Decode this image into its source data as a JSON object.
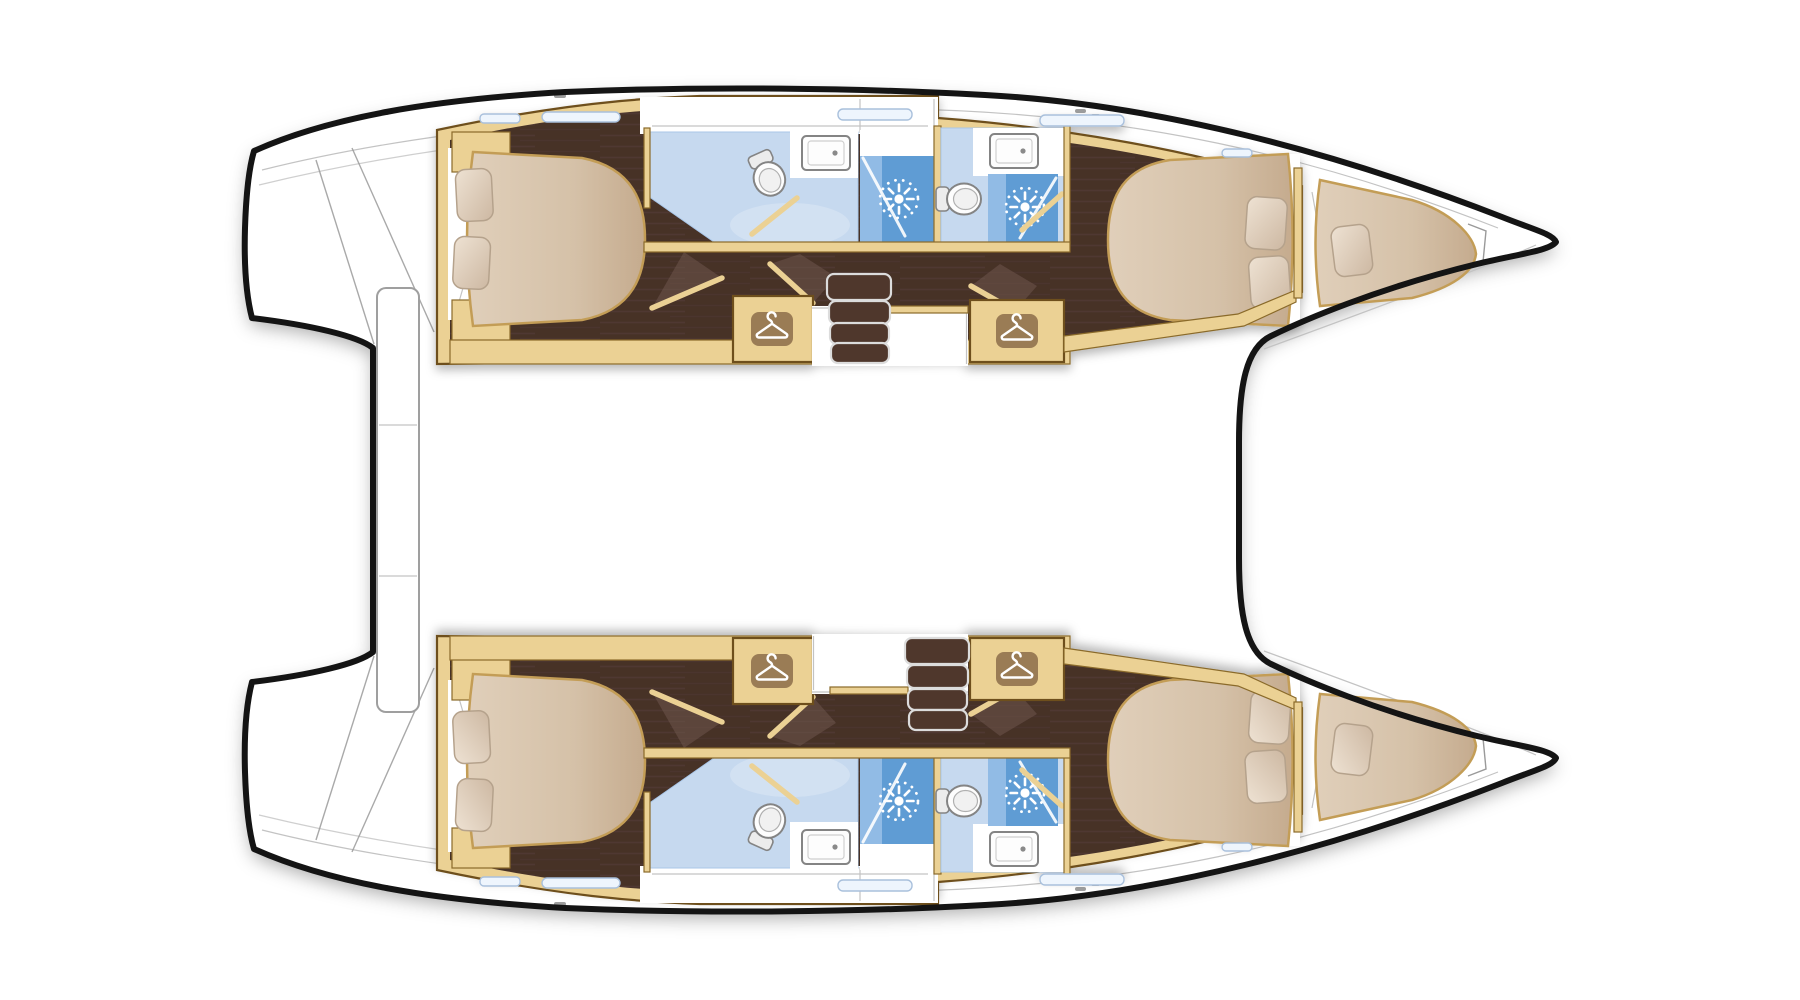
{
  "plan": {
    "type": "catamaran-interior-floor-plan",
    "features": {
      "hulls": 2,
      "double-cabins": 4,
      "forepeak-berths": 2,
      "bathrooms": 4,
      "showers": 4,
      "toilets": 4,
      "sinks": 4,
      "wardrobes": 4,
      "companionway-stairs": 2,
      "pillows": 10
    }
  },
  "icons": {
    "wardrobe-hanger-icon": "clothes hanger in rounded square",
    "shower-spray-icon": "starburst shower spray",
    "toilet-icon": "toilet top view",
    "sink-icon": "rectangular basin with drain dot",
    "stairs-icon": "stacked companionway treads"
  },
  "colors": {
    "outline": "#141414",
    "deck": "#ffffff",
    "line-soft": "#c3c3c3",
    "line-mid": "#9a9a9a",
    "wood": "#ebd194",
    "wood-dark": "#6e501f",
    "wood-line": "#8a6a2a",
    "floor": "#463028",
    "floor-light": "#6d564b",
    "mattress-border": "#c39d56",
    "pillow-border": "#b5a28c",
    "bath": "#c6d9ef",
    "bath-deep": "#a9c6e7",
    "shower": "#5f9cd4",
    "shower-light": "#a6c9ec",
    "fixture-stroke": "#848484",
    "hanger-box": "#9a7c55",
    "stair": "#4f372c",
    "stair-stroke": "#dcdcdc",
    "beam-stroke": "#9f9f9f",
    "slit": "#eef5fd",
    "slit-stroke": "#a9c0dc"
  }
}
